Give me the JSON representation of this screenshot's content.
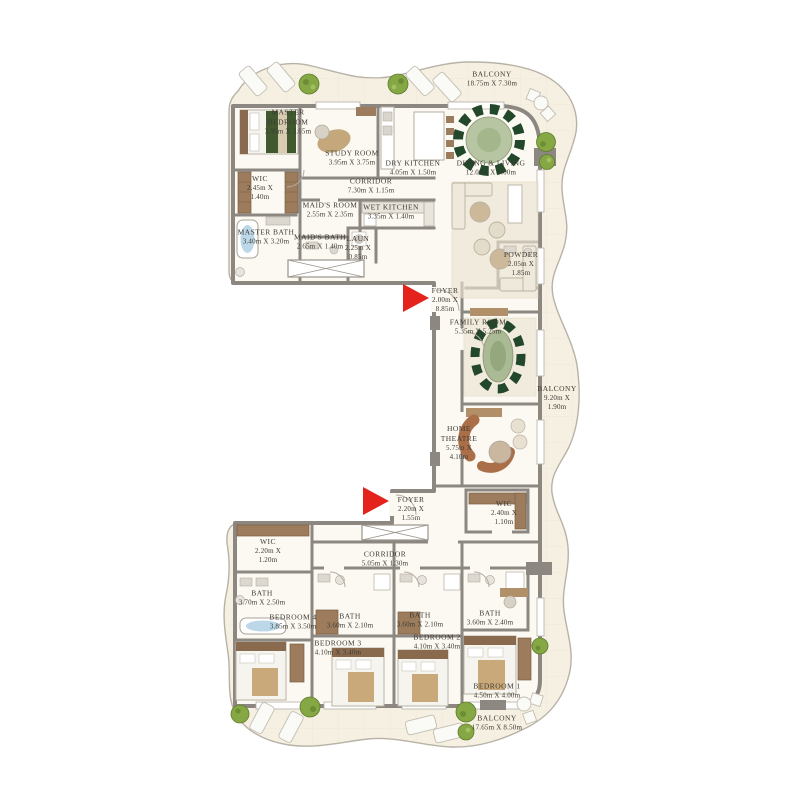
{
  "plan": {
    "type": "residential-floor-plan",
    "palette": {
      "wall_gray": "#8d8781",
      "floor_white": "#fcf9f2",
      "balcony_cream": "#f5f0e2",
      "entry_arrow_red": "#e3231c",
      "wood_brown": "#9c7c5c",
      "chair_dark_green": "#23472a",
      "tree_green": "#85a844",
      "tub_blue": "#bcd8e8",
      "label_text": "#3e3a33"
    }
  },
  "rooms": {
    "balcony_top": {
      "name": "BALCONY",
      "dims": "18.75m X 7.30m"
    },
    "master_bedroom": {
      "name": "MASTER BEDROOM",
      "dims": "3.95m X 3.65m"
    },
    "study_room": {
      "name": "STUDY ROOM",
      "dims": "3.95m X 3.75m"
    },
    "dry_kitchen": {
      "name": "DRY KITCHEN",
      "dims": "4.05m X 1.50m"
    },
    "dining_living": {
      "name": "DINING & LIVING",
      "dims": "12.00m X 6.00m"
    },
    "wic_master": {
      "name": "WIC",
      "dims": "2.45m X 1.40m"
    },
    "corridor_top": {
      "name": "CORRIDOR",
      "dims": "7.30m X 1.15m"
    },
    "maids_room": {
      "name": "MAID'S ROOM",
      "dims": "2.55m X 2.35m"
    },
    "wet_kitchen": {
      "name": "WET KITCHEN",
      "dims": "3.35m X 1.40m"
    },
    "master_bath": {
      "name": "MASTER BATH",
      "dims": "3.40m X 3.20m"
    },
    "maids_bath": {
      "name": "MAID'S BATH",
      "dims": "2.65m X 1.40m"
    },
    "laundry": {
      "name": "LAUN",
      "dims": "2.25m X 0.85m"
    },
    "powder": {
      "name": "POWDER",
      "dims": "2.05m X 1.85m"
    },
    "foyer_upper": {
      "name": "FOYER",
      "dims": "2.00m X 8.85m"
    },
    "family_room": {
      "name": "FAMILY ROOM",
      "dims": "5.35m X 5.25m"
    },
    "balcony_right": {
      "name": "BALCONY",
      "dims": "9.20m X 1.90m"
    },
    "home_theatre": {
      "name": "HOME THEATRE",
      "dims": "5.75m X 4.10m"
    },
    "wic_right": {
      "name": "WIC",
      "dims": "2.40m X 1.10m"
    },
    "foyer_lower": {
      "name": "FOYER",
      "dims": "2.20m X 1.55m"
    },
    "corridor_lower": {
      "name": "CORRIDOR",
      "dims": "5.05m X 1.30m"
    },
    "wic_lower": {
      "name": "WIC",
      "dims": "2.20m X 1.20m"
    },
    "bath_4": {
      "name": "BATH",
      "dims": "3.70m X 2.50m"
    },
    "bedroom_4": {
      "name": "BEDROOM 4",
      "dims": "3.85m X 3.50m"
    },
    "bath_3": {
      "name": "BATH",
      "dims": "3.60m X 2.10m"
    },
    "bedroom_3": {
      "name": "BEDROOM 3",
      "dims": "4.10m X 3.40m"
    },
    "bath_2": {
      "name": "BATH",
      "dims": "3.60m X 2.10m"
    },
    "bedroom_2": {
      "name": "BEDROOM 2",
      "dims": "4.10m X 3.40m"
    },
    "bath_1": {
      "name": "BATH",
      "dims": "3.60m X 2.40m"
    },
    "bedroom_1": {
      "name": "BEDROOM 1",
      "dims": "4.50m X 4.00m"
    },
    "balcony_bottom": {
      "name": "BALCONY",
      "dims": "17.65m X 8.50m"
    }
  }
}
